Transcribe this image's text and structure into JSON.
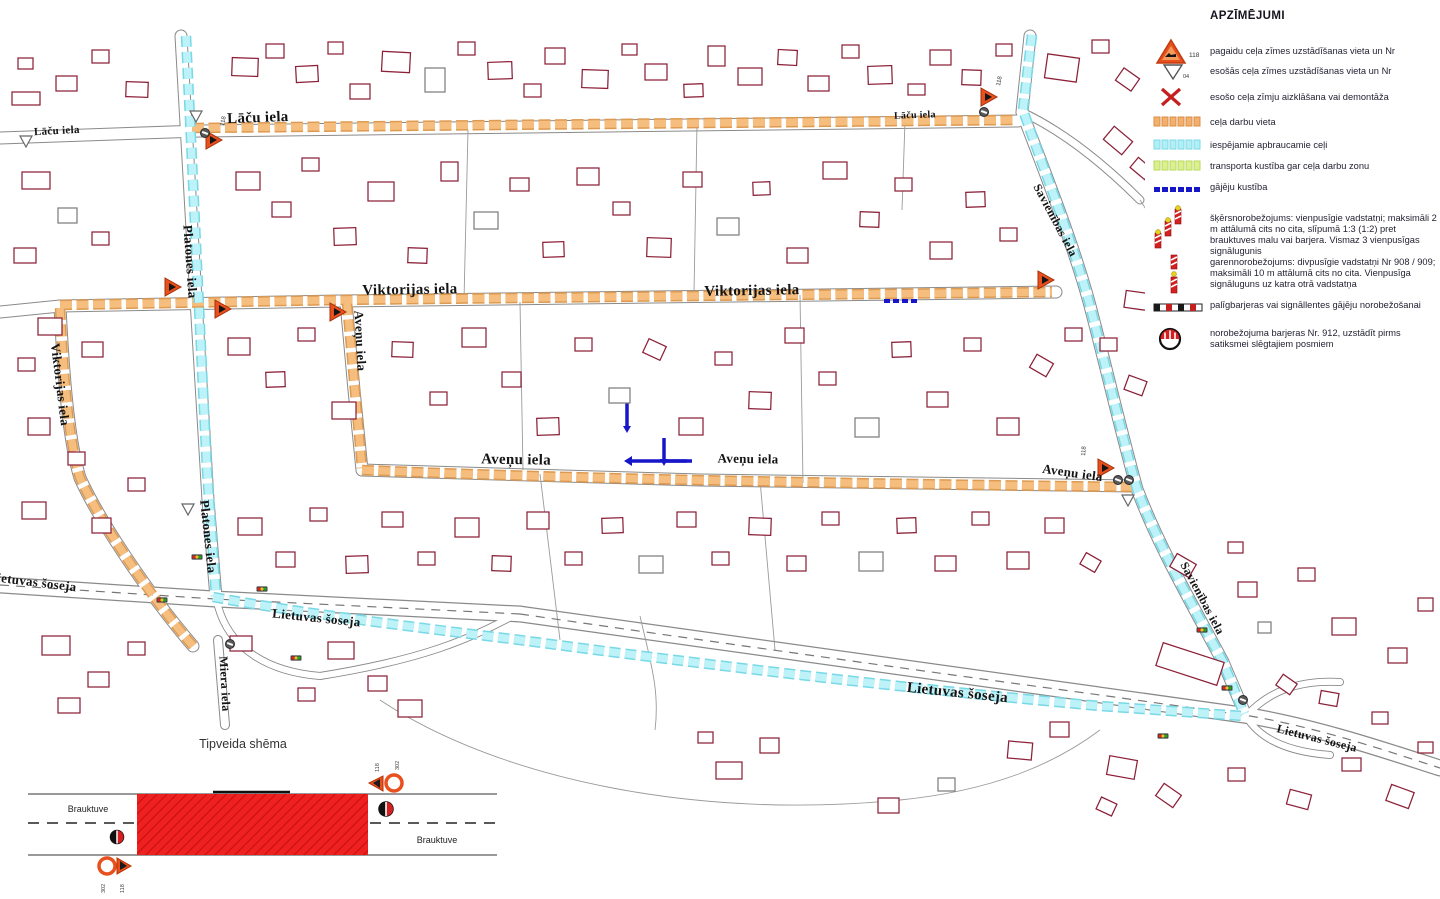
{
  "legend": {
    "title": "APZĪMĒJUMI",
    "items": [
      {
        "name": "temporary-road-sign",
        "number": "118",
        "label": "pagaidu ceļa zīmes uzstādīšanas vieta un Nr"
      },
      {
        "name": "existing-road-sign",
        "number": "04",
        "label": "esošās ceļa zīmes uzstādīšanas vieta un Nr"
      },
      {
        "name": "sign-cover-or-dismantle",
        "label": "esošo ceļa zīmju aizklāšana vai demontāža"
      },
      {
        "name": "roadworks-location",
        "label": "ceļa darbu vieta"
      },
      {
        "name": "possible-detour-routes",
        "label": "iespējamie apbraucamie ceļi"
      },
      {
        "name": "traffic-along-workzone",
        "label": "transporta kustība gar ceļa darbu zonu"
      },
      {
        "name": "pedestrian-movement",
        "label": "gājēju kustība"
      },
      {
        "name": "transverse-delineation",
        "label": "šķērsnorobežojums: vienpusīgie vadstatņi; maksimāli 2 m attālumā cits no cita, slīpumā 1:3 (1:2) pret brauktuves malu vai barjera. Vismaz 3 vienpusīgas signālugunis"
      },
      {
        "name": "longitudinal-delineation",
        "label": "garennorobežojums: divpusīgie vadstatņi Nr 908 / 909; maksimāli 10 m attālumā cits no cita. Vienpusīga signāluguns uz katra otrā vadstatņa"
      },
      {
        "name": "auxiliary-barriers",
        "label": "palīgbarjeras vai signāllentes gājēju norobežošanai"
      },
      {
        "name": "delimitation-barrier-912",
        "label": "norobežojuma barjeras Nr. 912, uzstādīt pirms satiksmei slēgtajiem posmiem"
      }
    ]
  },
  "scheme": {
    "title": "Tipveida shēma",
    "carriageway_label": "Brauktuve",
    "sign_triangle_number": "118",
    "sign_circle_number": "302"
  },
  "map": {
    "street_labels": [
      {
        "text": "Lāču iela",
        "x": 57,
        "y": 134,
        "rot": -3,
        "size": 11
      },
      {
        "text": "Lāču iela",
        "x": 258,
        "y": 122,
        "rot": -2,
        "size": 15
      },
      {
        "text": "Lāču iela",
        "x": 915,
        "y": 118,
        "rot": -2,
        "size": 10
      },
      {
        "text": "Viktorijas iela",
        "x": 410,
        "y": 294,
        "rot": -1,
        "size": 15
      },
      {
        "text": "Viktorijas iela",
        "x": 752,
        "y": 295,
        "rot": -1,
        "size": 15
      },
      {
        "text": "Viktorijas iela",
        "x": 56,
        "y": 385,
        "rot": 83,
        "size": 13
      },
      {
        "text": "Platones iela",
        "x": 186,
        "y": 262,
        "rot": 86,
        "size": 13
      },
      {
        "text": "Platones iela",
        "x": 204,
        "y": 537,
        "rot": 84,
        "size": 13
      },
      {
        "text": "Aveņu iela",
        "x": 356,
        "y": 341,
        "rot": 87,
        "size": 13
      },
      {
        "text": "Aveņu iela",
        "x": 516,
        "y": 464,
        "rot": 1,
        "size": 15
      },
      {
        "text": "Aveņu iela",
        "x": 748,
        "y": 463,
        "rot": 1,
        "size": 13
      },
      {
        "text": "Aveņu iela",
        "x": 1072,
        "y": 477,
        "rot": 8,
        "size": 13
      },
      {
        "text": "Savienības iela",
        "x": 1052,
        "y": 222,
        "rot": 62,
        "size": 12
      },
      {
        "text": "Savienības iela",
        "x": 1199,
        "y": 600,
        "rot": 62,
        "size": 12
      },
      {
        "text": "Lietuvas šoseja",
        "x": 32,
        "y": 586,
        "rot": 7,
        "size": 13
      },
      {
        "text": "Lietuvas šoseja",
        "x": 316,
        "y": 622,
        "rot": 6,
        "size": 13
      },
      {
        "text": "Lietuvas šoseja",
        "x": 957,
        "y": 697,
        "rot": 6,
        "size": 15
      },
      {
        "text": "Lietuvas šoseja",
        "x": 1316,
        "y": 742,
        "rot": 14,
        "size": 12
      },
      {
        "text": "Miera iela",
        "x": 221,
        "y": 684,
        "rot": 87,
        "size": 12
      }
    ],
    "buildings": [
      [
        232,
        58,
        26,
        18,
        2
      ],
      [
        266,
        44,
        18,
        14,
        0
      ],
      [
        296,
        66,
        22,
        16,
        -3
      ],
      [
        328,
        42,
        15,
        12,
        0
      ],
      [
        350,
        84,
        20,
        15,
        0
      ],
      [
        382,
        52,
        28,
        20,
        3
      ],
      [
        425,
        68,
        20,
        24,
        0,
        1
      ],
      [
        458,
        42,
        17,
        13,
        0
      ],
      [
        488,
        62,
        24,
        17,
        -2
      ],
      [
        524,
        84,
        17,
        13,
        0
      ],
      [
        545,
        48,
        20,
        16,
        0
      ],
      [
        582,
        70,
        26,
        18,
        2
      ],
      [
        622,
        44,
        15,
        11,
        0
      ],
      [
        645,
        64,
        22,
        16,
        0
      ],
      [
        684,
        84,
        19,
        13,
        -2
      ],
      [
        708,
        46,
        17,
        20,
        0
      ],
      [
        738,
        68,
        24,
        17,
        0
      ],
      [
        778,
        50,
        19,
        15,
        3
      ],
      [
        808,
        76,
        21,
        15,
        0
      ],
      [
        842,
        45,
        17,
        13,
        0
      ],
      [
        868,
        66,
        24,
        18,
        -2
      ],
      [
        908,
        84,
        17,
        11,
        0
      ],
      [
        930,
        50,
        21,
        15,
        0
      ],
      [
        962,
        70,
        19,
        15,
        2
      ],
      [
        996,
        44,
        16,
        12,
        0
      ],
      [
        12,
        92,
        28,
        13,
        0
      ],
      [
        56,
        76,
        21,
        15,
        0
      ],
      [
        92,
        50,
        17,
        13,
        0
      ],
      [
        126,
        82,
        22,
        15,
        2
      ],
      [
        18,
        58,
        15,
        11,
        0
      ],
      [
        1046,
        56,
        32,
        24,
        8
      ],
      [
        1092,
        40,
        17,
        13,
        0
      ],
      [
        1118,
        72,
        19,
        15,
        35
      ],
      [
        1106,
        132,
        24,
        17,
        40
      ],
      [
        1132,
        162,
        19,
        13,
        40
      ],
      [
        236,
        172,
        24,
        18,
        0
      ],
      [
        272,
        202,
        19,
        15,
        0
      ],
      [
        302,
        158,
        17,
        13,
        0
      ],
      [
        334,
        228,
        22,
        17,
        -2
      ],
      [
        368,
        182,
        26,
        19,
        0
      ],
      [
        408,
        248,
        19,
        15,
        2
      ],
      [
        441,
        162,
        17,
        19,
        0
      ],
      [
        474,
        212,
        24,
        17,
        0,
        1
      ],
      [
        510,
        178,
        19,
        13,
        0
      ],
      [
        543,
        242,
        21,
        15,
        -2
      ],
      [
        577,
        168,
        22,
        17,
        0
      ],
      [
        613,
        202,
        17,
        13,
        0
      ],
      [
        647,
        238,
        24,
        19,
        2
      ],
      [
        683,
        172,
        19,
        15,
        0
      ],
      [
        717,
        218,
        22,
        17,
        0,
        1
      ],
      [
        753,
        182,
        17,
        13,
        -2
      ],
      [
        787,
        248,
        21,
        15,
        0
      ],
      [
        823,
        162,
        24,
        17,
        0
      ],
      [
        860,
        212,
        19,
        15,
        2
      ],
      [
        895,
        178,
        17,
        13,
        0
      ],
      [
        930,
        242,
        22,
        17,
        0
      ],
      [
        966,
        192,
        19,
        15,
        -2
      ],
      [
        1000,
        228,
        17,
        13,
        0
      ],
      [
        22,
        172,
        28,
        17,
        0
      ],
      [
        58,
        208,
        19,
        15,
        0,
        1
      ],
      [
        14,
        248,
        22,
        15,
        0
      ],
      [
        92,
        232,
        17,
        13,
        0
      ],
      [
        38,
        318,
        24,
        17,
        0
      ],
      [
        18,
        358,
        17,
        13,
        0
      ],
      [
        82,
        342,
        21,
        15,
        0
      ],
      [
        28,
        418,
        22,
        17,
        0
      ],
      [
        68,
        452,
        17,
        13,
        0
      ],
      [
        22,
        502,
        24,
        17,
        0
      ],
      [
        92,
        518,
        19,
        15,
        0
      ],
      [
        128,
        478,
        17,
        13,
        0
      ],
      [
        228,
        338,
        22,
        17,
        0
      ],
      [
        266,
        372,
        19,
        15,
        -2
      ],
      [
        298,
        328,
        17,
        13,
        0
      ],
      [
        332,
        402,
        24,
        17,
        0
      ],
      [
        392,
        342,
        21,
        15,
        2
      ],
      [
        430,
        392,
        17,
        13,
        0
      ],
      [
        462,
        328,
        24,
        19,
        0
      ],
      [
        502,
        372,
        19,
        15,
        0
      ],
      [
        537,
        418,
        22,
        17,
        -2
      ],
      [
        575,
        338,
        17,
        13,
        0
      ],
      [
        609,
        388,
        21,
        15,
        0,
        1
      ],
      [
        645,
        342,
        19,
        15,
        25
      ],
      [
        679,
        418,
        24,
        17,
        0
      ],
      [
        715,
        352,
        17,
        13,
        0
      ],
      [
        749,
        392,
        22,
        17,
        2
      ],
      [
        785,
        328,
        19,
        15,
        0
      ],
      [
        819,
        372,
        17,
        13,
        0
      ],
      [
        855,
        418,
        24,
        19,
        0,
        1
      ],
      [
        892,
        342,
        19,
        15,
        -2
      ],
      [
        927,
        392,
        21,
        15,
        0
      ],
      [
        964,
        338,
        17,
        13,
        0
      ],
      [
        997,
        418,
        22,
        17,
        0
      ],
      [
        1032,
        358,
        19,
        15,
        30
      ],
      [
        1065,
        328,
        17,
        13,
        0
      ],
      [
        1100,
        338,
        17,
        13,
        0
      ],
      [
        1125,
        292,
        24,
        17,
        8
      ],
      [
        1126,
        378,
        19,
        15,
        20
      ],
      [
        238,
        518,
        24,
        17,
        0
      ],
      [
        276,
        552,
        19,
        15,
        0
      ],
      [
        310,
        508,
        17,
        13,
        0
      ],
      [
        346,
        556,
        22,
        17,
        -2
      ],
      [
        382,
        512,
        21,
        15,
        0
      ],
      [
        418,
        552,
        17,
        13,
        0
      ],
      [
        455,
        518,
        24,
        19,
        0
      ],
      [
        492,
        556,
        19,
        15,
        2
      ],
      [
        527,
        512,
        22,
        17,
        0
      ],
      [
        565,
        552,
        17,
        13,
        0
      ],
      [
        602,
        518,
        21,
        15,
        -2
      ],
      [
        639,
        556,
        24,
        17,
        0,
        1
      ],
      [
        677,
        512,
        19,
        15,
        0
      ],
      [
        712,
        552,
        17,
        13,
        0
      ],
      [
        749,
        518,
        22,
        17,
        2
      ],
      [
        787,
        556,
        19,
        15,
        0
      ],
      [
        822,
        512,
        17,
        13,
        0
      ],
      [
        859,
        552,
        24,
        19,
        0,
        1
      ],
      [
        897,
        518,
        19,
        15,
        -2
      ],
      [
        935,
        556,
        21,
        15,
        0
      ],
      [
        972,
        512,
        17,
        13,
        0
      ],
      [
        1007,
        552,
        22,
        17,
        0
      ],
      [
        1045,
        518,
        19,
        15,
        0
      ],
      [
        1082,
        556,
        17,
        13,
        30
      ],
      [
        42,
        636,
        28,
        19,
        0
      ],
      [
        88,
        672,
        21,
        15,
        0
      ],
      [
        128,
        642,
        17,
        13,
        0
      ],
      [
        230,
        636,
        22,
        15,
        0
      ],
      [
        328,
        642,
        26,
        17,
        0
      ],
      [
        368,
        676,
        19,
        15,
        0
      ],
      [
        58,
        698,
        22,
        15,
        0
      ],
      [
        298,
        688,
        17,
        13,
        0
      ],
      [
        398,
        700,
        24,
        17,
        0
      ],
      [
        716,
        762,
        26,
        17,
        0
      ],
      [
        760,
        738,
        19,
        15,
        0
      ],
      [
        1008,
        742,
        24,
        17,
        5
      ],
      [
        1050,
        722,
        19,
        15,
        0
      ],
      [
        1108,
        758,
        28,
        19,
        10
      ],
      [
        1158,
        788,
        21,
        15,
        35
      ],
      [
        1228,
        768,
        17,
        13,
        0
      ],
      [
        1288,
        792,
        22,
        15,
        15
      ],
      [
        1342,
        758,
        19,
        13,
        0
      ],
      [
        1388,
        788,
        24,
        17,
        20
      ],
      [
        1418,
        742,
        15,
        11,
        0
      ],
      [
        878,
        798,
        21,
        15,
        0
      ],
      [
        938,
        778,
        17,
        13,
        0,
        1
      ],
      [
        698,
        732,
        15,
        11,
        0
      ],
      [
        1098,
        800,
        17,
        13,
        25
      ],
      [
        1172,
        558,
        22,
        15,
        30
      ],
      [
        1238,
        582,
        19,
        15,
        0
      ],
      [
        1298,
        568,
        17,
        13,
        0
      ],
      [
        1228,
        542,
        15,
        11,
        0
      ],
      [
        1332,
        618,
        24,
        17,
        0
      ],
      [
        1388,
        648,
        19,
        15,
        0
      ],
      [
        1278,
        678,
        17,
        13,
        35
      ],
      [
        1418,
        598,
        15,
        13,
        0
      ],
      [
        1258,
        622,
        13,
        11,
        0,
        1
      ],
      [
        1158,
        652,
        64,
        24,
        18
      ],
      [
        1320,
        692,
        18,
        13,
        10
      ],
      [
        1372,
        712,
        16,
        12,
        0
      ]
    ],
    "warning_triangles": [
      [
        213,
        140
      ],
      [
        988,
        97
      ],
      [
        172,
        287
      ],
      [
        222,
        309
      ],
      [
        337,
        312
      ],
      [
        1045,
        280
      ],
      [
        1105,
        468
      ]
    ],
    "existing_triangles": [
      [
        196,
        116
      ],
      [
        26,
        141
      ],
      [
        188,
        509
      ],
      [
        1128,
        500
      ]
    ],
    "barrier_circles": [
      [
        205,
        133
      ],
      [
        984,
        112
      ],
      [
        1118,
        480
      ],
      [
        1129,
        480
      ],
      [
        1243,
        700
      ],
      [
        230,
        644
      ]
    ],
    "traffic_lights": [
      [
        162,
        600
      ],
      [
        197,
        557
      ],
      [
        262,
        589
      ],
      [
        296,
        658
      ],
      [
        1202,
        630
      ],
      [
        1227,
        688
      ],
      [
        1163,
        736
      ]
    ],
    "sign_numbers": [
      {
        "text": "118",
        "x": 1000,
        "y": 86,
        "rot": -80
      },
      {
        "text": "118",
        "x": 1085,
        "y": 456,
        "rot": -85
      },
      {
        "text": "118",
        "x": 224,
        "y": 126,
        "rot": -80
      }
    ]
  },
  "colors": {
    "roadworks": "#F2AF6E",
    "roadworks_edge": "#DE9A50",
    "roadworks_core": "#F5BE7E",
    "detour": "#A9EDF4",
    "detour_edge": "#77D8E6",
    "detour_core": "#BDF3F8",
    "traffic_zone": "#DCEF8F",
    "pedestrian": "#1717C9",
    "building": "#8C2038",
    "warning": "#E8501E",
    "red_marking": "#E82019"
  }
}
